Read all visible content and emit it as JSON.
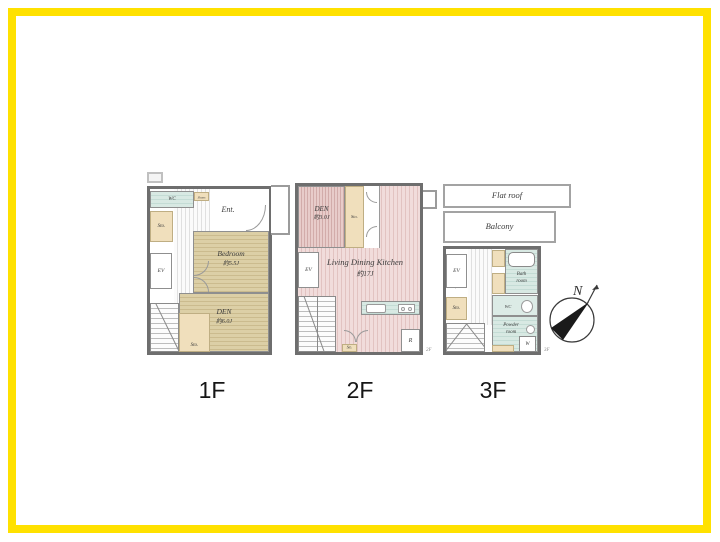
{
  "frame": {
    "border_color": "#FFE100"
  },
  "compass": {
    "north": "N"
  },
  "colors": {
    "frame_yellow": "#FFE100",
    "wall_gray": "#6e6e6e",
    "wood_floor": "#DCCFA6",
    "ldk_pink": "#F1DCDB",
    "den2f_mauve": "#E8CCCA",
    "wet_area_teal": "#D8E9E3",
    "closet_beige": "#F0DFBC"
  },
  "floors": {
    "f1": {
      "label": "1F",
      "corner_mark": "1F",
      "wc": "WC",
      "shoes_box": "Shoes Box",
      "ent": "Ent.",
      "hall": "Hall",
      "sto_upper": "Sto.",
      "ev": "EV",
      "bedroom_name": "Bedroom",
      "bedroom_size": "約5.5J",
      "den_name": "DEN",
      "den_size": "約6.0J",
      "sto_lower": "Sto."
    },
    "f2": {
      "label": "2F",
      "corner_mark": "2F",
      "den_name": "DEN",
      "den_size": "約3.0J",
      "closet": "Sto.",
      "ev": "EV",
      "ldk_name": "Living Dining Kitchen",
      "ldk_size": "約17J",
      "sto_bottom": "Sto.",
      "fridge": "R"
    },
    "f3": {
      "label": "3F",
      "corner_mark": "3F",
      "flat_roof": "Flat roof",
      "balcony": "Balcony",
      "ev": "EV",
      "sto": "Sto.",
      "hall": "Hall",
      "bath_name": "Bath",
      "bath_sub": "room",
      "wc": "WC",
      "powder_name": "Powder",
      "powder_sub": "room",
      "washer": "W"
    }
  }
}
